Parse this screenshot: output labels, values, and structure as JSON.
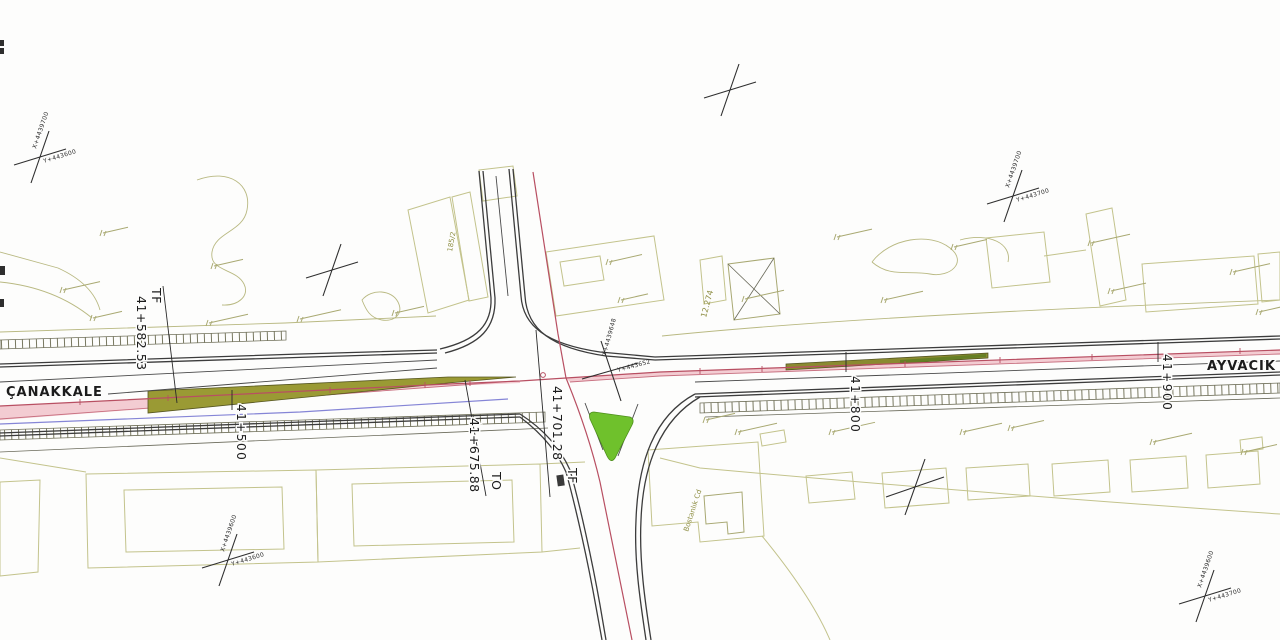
{
  "destinations": {
    "west": "ÇANAKKALE",
    "east": "AYVACIK"
  },
  "stations": {
    "km_41_500": "41+500",
    "km_41_800": "41+800",
    "km_41_900": "41+900"
  },
  "curve_points": {
    "tf_west": {
      "tag": "TF",
      "chainage": "41+582.53"
    },
    "to_mid": {
      "tag": "TO",
      "chainage": "41+675.88"
    },
    "tf_mid": {
      "tag": "TF",
      "chainage": "41+701.28"
    }
  },
  "grid_crosses": {
    "top_left": {
      "x_label": "X+4439700",
      "y_label": "Y+443600"
    },
    "top_right": {
      "x_label": "X+4439700",
      "y_label": "Y+443700"
    },
    "bottom_left": {
      "x_label": "X+4439600",
      "y_label": "Y+443600"
    },
    "bottom_right": {
      "x_label": "X+4439600",
      "y_label": "Y+443700"
    },
    "junction": {
      "x_label": "X+4439648",
      "y_label": "Y+443652"
    }
  },
  "annotations": {
    "offset_value": "12.274",
    "street_name": "Bostanlık Cd",
    "parcel_number": "185/2"
  },
  "colors": {
    "centerline-red": "#b84f62",
    "lane-pink": "#f3ccd2",
    "utility-blue": "#8585d6",
    "median-olive": "#9a9a34",
    "island-green": "#6fc12c",
    "parcel-olive": "#c3c38c",
    "road-dark": "#3c3c3c"
  }
}
